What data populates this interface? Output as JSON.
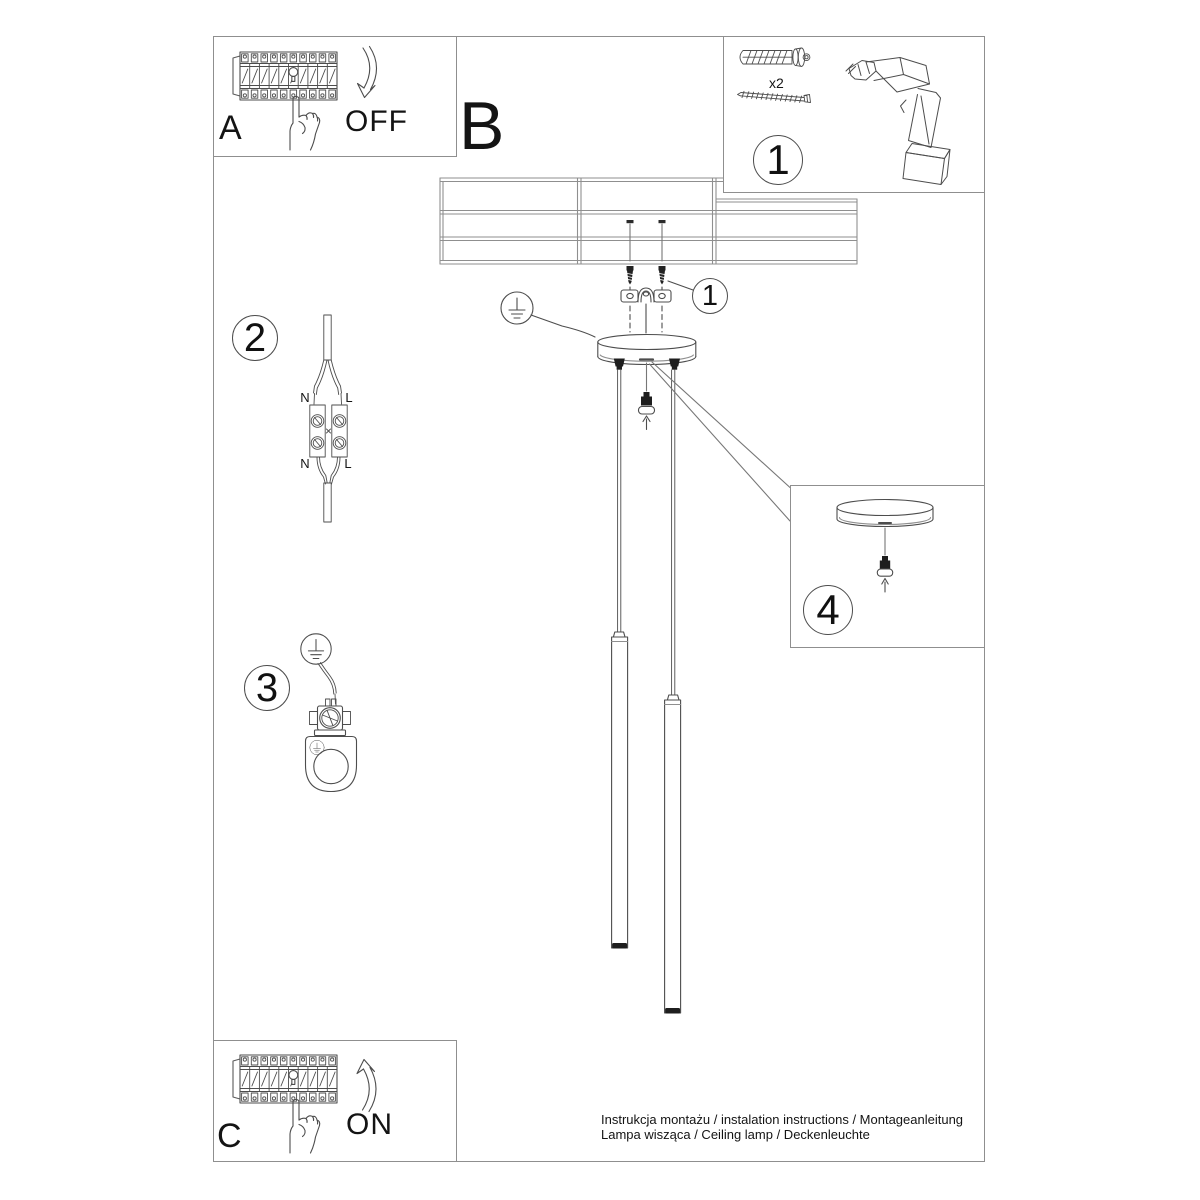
{
  "colors": {
    "line": "#4d4d4d",
    "frame": "#8f8f8f",
    "text": "#141414",
    "bg": "#ffffff"
  },
  "steps": {
    "breaker_off": {
      "label": "A",
      "state": "OFF"
    },
    "section_b": {
      "label": "B"
    },
    "tools": {
      "badge": "1",
      "dowel_qty": "x2"
    },
    "mount": {
      "badge": "1"
    },
    "wiring": {
      "badge": "2",
      "terminals": {
        "top_left": "N",
        "top_right": "L",
        "bottom_left": "N",
        "bottom_right": "L"
      }
    },
    "ground": {
      "badge": "3"
    },
    "canopy_detail": {
      "badge": "4"
    },
    "breaker_on": {
      "label": "C",
      "state": "ON"
    }
  },
  "footer": {
    "line1": "Instrukcja montażu / instalation instructions / Montageanleitung",
    "line2": "Lampa wisząca / Ceiling lamp / Deckenleuchte"
  }
}
